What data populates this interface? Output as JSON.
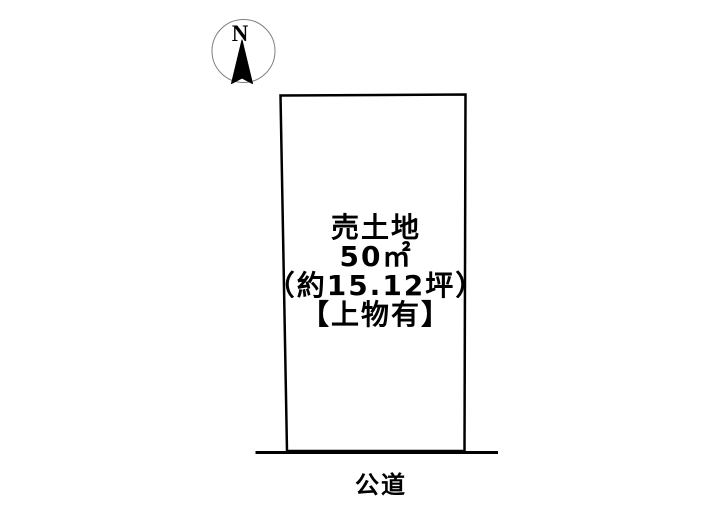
{
  "compass": {
    "north_label": "N"
  },
  "parcel": {
    "listing_type": "売土地",
    "area_sqm": "50㎡",
    "area_tsubo": "（約15.12坪）",
    "building_note": "【上物有】"
  },
  "road": {
    "label": "公道"
  },
  "colors": {
    "background": "#ffffff",
    "outline": "#000000",
    "compass_ring": "#808080"
  }
}
